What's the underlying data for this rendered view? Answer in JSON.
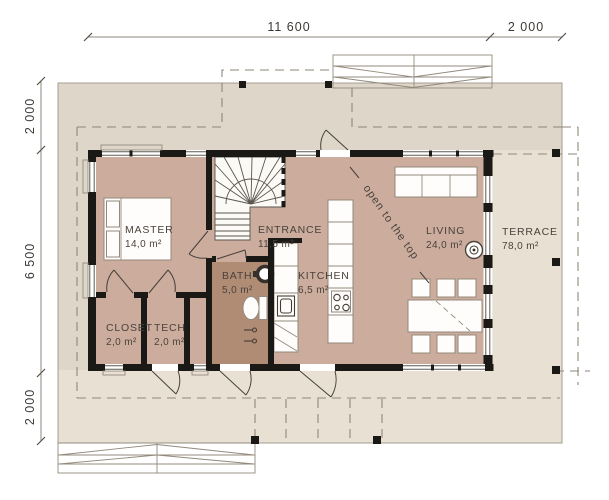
{
  "colors": {
    "outer_band": "#ded6c8",
    "terrace_deck": "#e8e0d3",
    "floor": "#cbac9d",
    "bath_floor": "#b18c75",
    "wall": "#1b1916",
    "line": "#8f8779",
    "text": "#49423b",
    "white": "#ffffff"
  },
  "dimensions": {
    "top": [
      {
        "label": "11 600"
      },
      {
        "label": "2 000"
      }
    ],
    "left": [
      {
        "label": "2 000"
      },
      {
        "label": "6 500"
      },
      {
        "label": "2 000"
      }
    ]
  },
  "rooms": {
    "master": {
      "name": "MASTER",
      "area": "14,0 m²"
    },
    "entrance": {
      "name": "ENTRANCE",
      "area": "11,5 m²"
    },
    "bath": {
      "name": "BATH",
      "area": "5,0 m²"
    },
    "kitchen": {
      "name": "KITCHEN",
      "area": "6,5 m²"
    },
    "living": {
      "name": "LIVING",
      "area": "24,0 m²"
    },
    "terrace": {
      "name": "TERRACE",
      "area": "78,0 m²"
    },
    "closet": {
      "name": "CLOSET",
      "area": "2,0 m²"
    },
    "tech": {
      "name": "TECH",
      "area": "2,0 m²"
    }
  },
  "annotations": {
    "open_to_top": "open to the top"
  }
}
